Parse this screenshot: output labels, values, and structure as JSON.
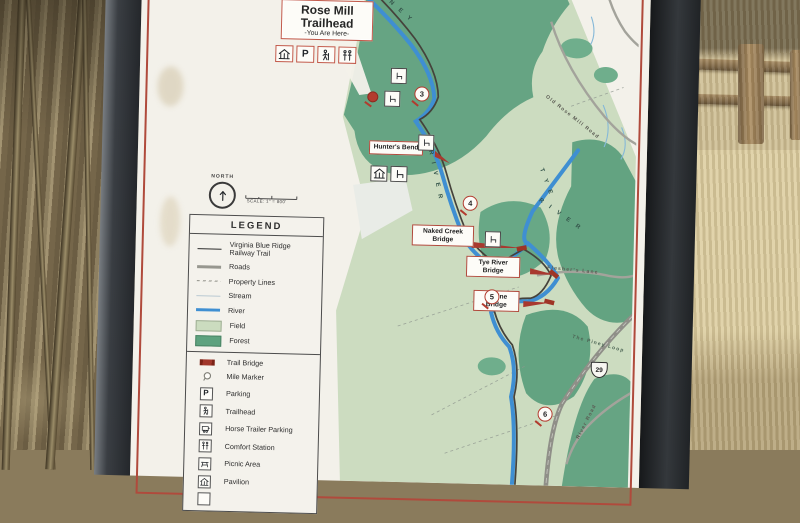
{
  "colors": {
    "frame": "#33363a",
    "panel": "#f3f1ea",
    "pinstripe": "#b04a3c",
    "field": "#ccdcc0",
    "forest": "#63a381",
    "river": "#3f8fd2",
    "road": "#a3a39b",
    "trail": "#45423b",
    "label_red": "#a8392f"
  },
  "title_box": {
    "title": "Rose Mill Trailhead",
    "subtitle": "-You Are Here-"
  },
  "compass": {
    "north_label": "NORTH",
    "scale_text": "SCALE: 1\" = 800'"
  },
  "legend": {
    "header": "LEGEND",
    "line_items": [
      {
        "label": "Virginia Blue Ridge Railway Trail"
      },
      {
        "label": "Roads"
      },
      {
        "label": "Property Lines"
      },
      {
        "label": "Stream"
      },
      {
        "label": "River"
      },
      {
        "label": "Field"
      },
      {
        "label": "Forest"
      }
    ],
    "symbol_items": [
      {
        "label": "Trail Bridge"
      },
      {
        "label": "Mile Marker"
      },
      {
        "label": "Parking"
      },
      {
        "label": "Trailhead"
      },
      {
        "label": "Horse Trailer Parking"
      },
      {
        "label": "Comfort Station"
      },
      {
        "label": "Picnic Area"
      },
      {
        "label": "Pavilion"
      }
    ]
  },
  "map": {
    "poi_labels": [
      {
        "label": "Hunter's Bend"
      },
      {
        "label": "Naked Creek Bridge"
      },
      {
        "label": "Tye River Bridge"
      },
      {
        "label": "Ravine Bridge"
      }
    ],
    "mile_markers": [
      "3",
      "4",
      "5",
      "6"
    ],
    "road_labels": [
      "Old Rose Mill Road",
      "Flesher's Lane",
      "The Piney Loop",
      "River Road"
    ],
    "water_labels": [
      "P I N E Y",
      "R I V E R",
      "T Y E",
      "R I V E R"
    ],
    "route_shield": "29"
  }
}
